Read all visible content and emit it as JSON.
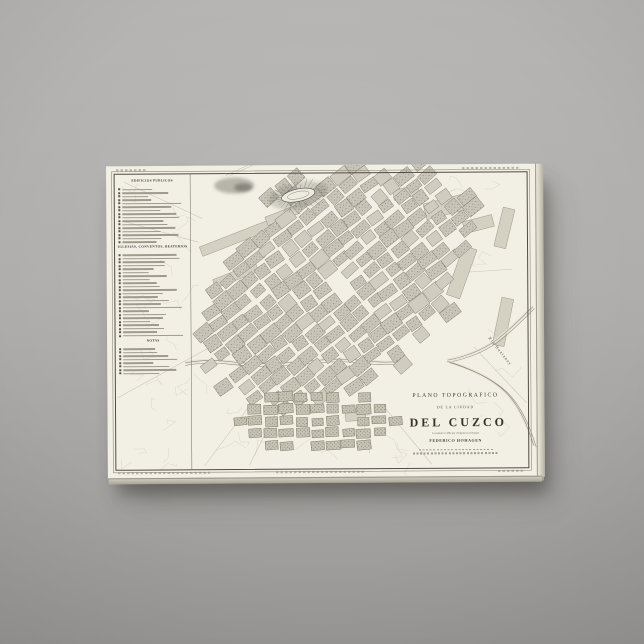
{
  "scene": {
    "wall_color_top": "#b7b5b3",
    "wall_color_bottom": "#9b9997",
    "canvas_color": "#f4f1e6"
  },
  "map": {
    "paper_color": "#f2efe4",
    "block_color": "#c9c6b9",
    "suburb_block_color": "#c6c3b4",
    "frame_color": "#4f4d44",
    "title_block": {
      "title_line1": "PLANO TOPOGRAFICO",
      "title_line2": "DE LA CIUDAD",
      "title_line3": "DEL CUZCO",
      "subtitle": "Levantado en 1861 por el Ingeniero del Estado",
      "author": "FEDERICO HOHAGEN"
    },
    "legend": {
      "sections": [
        {
          "title": "EDIFICIOS PUBLICOS",
          "items": 16
        },
        {
          "title": "IGLESIAS, CONVENTOS, BEATERIOS",
          "items": 24
        },
        {
          "title": "NOTAS",
          "items": 8
        }
      ]
    },
    "labels": {
      "river": "Rio Huatanay"
    }
  }
}
